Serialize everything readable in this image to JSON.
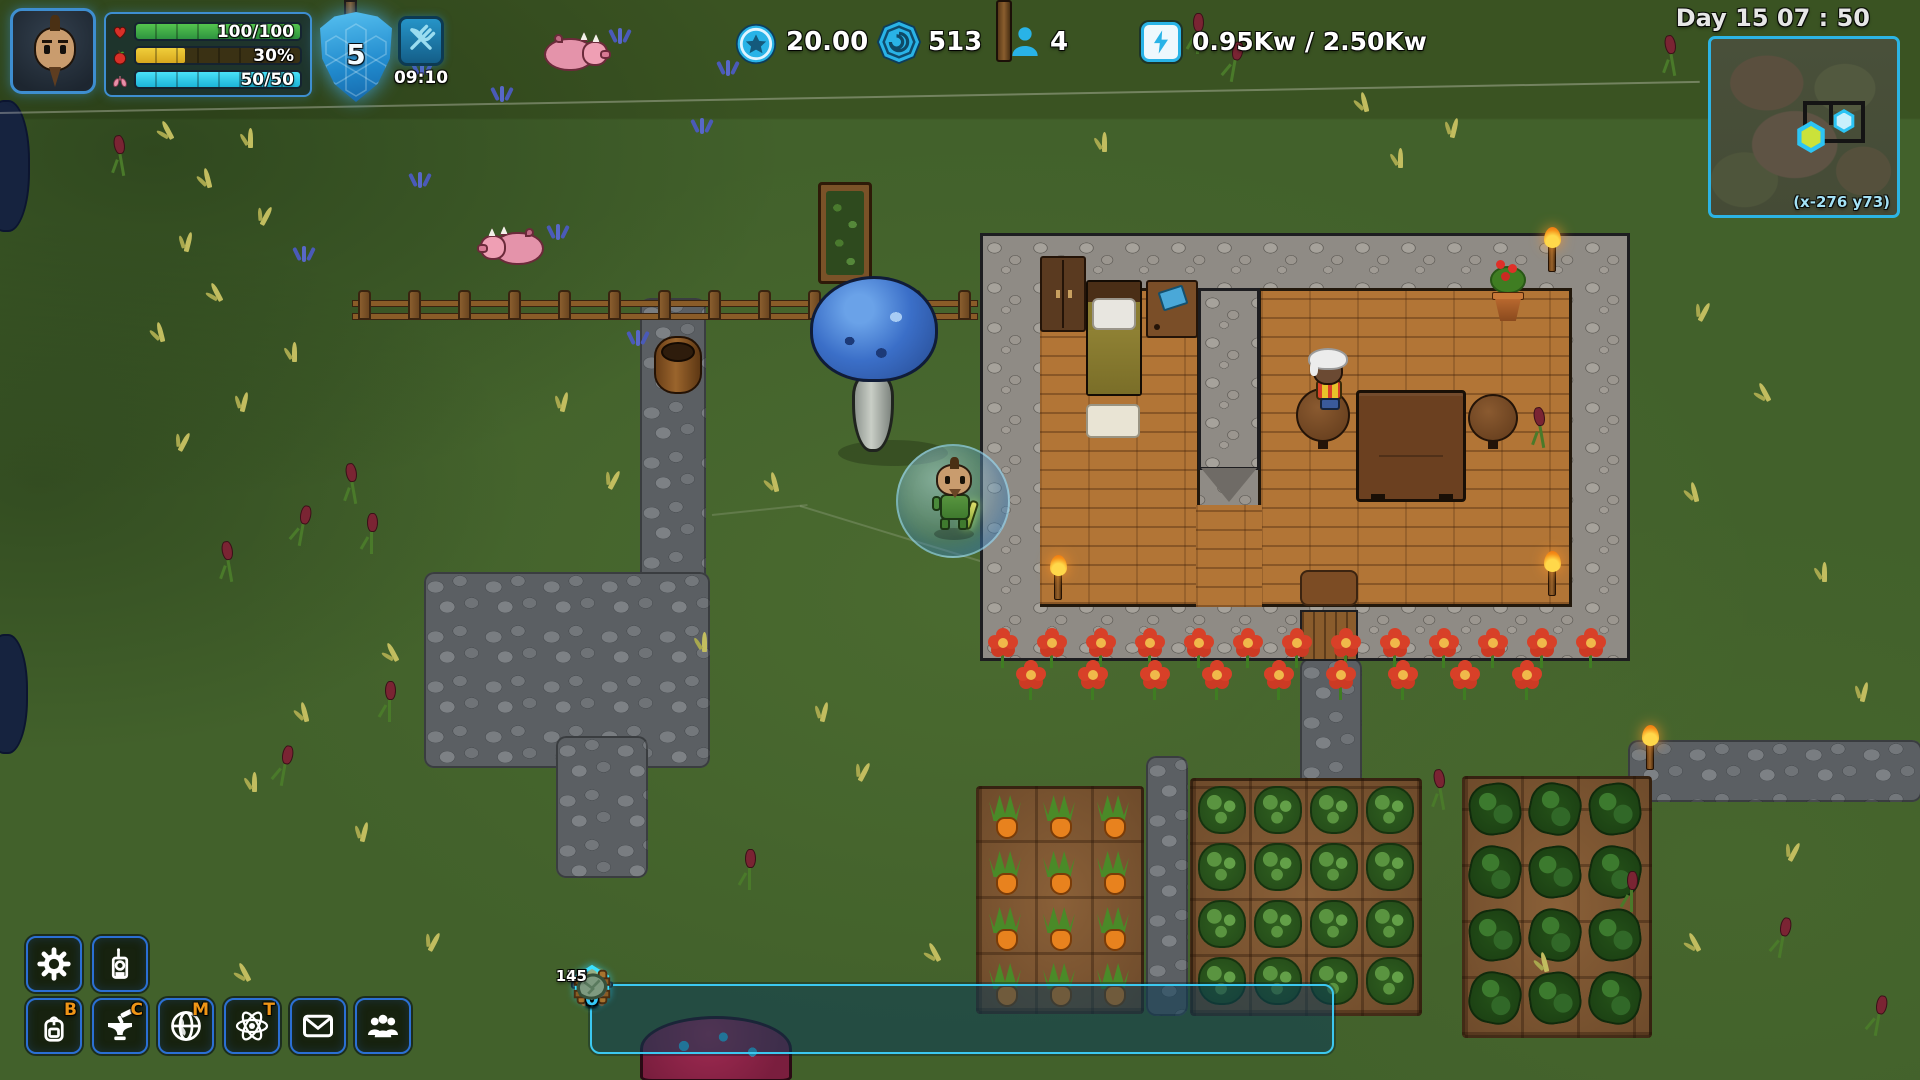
{
  "hud": {
    "player": {
      "health": {
        "value": "100/100",
        "color": "#3fae49",
        "icon": "heart-icon"
      },
      "hunger": {
        "value": "30%",
        "color": "#e8c22f",
        "icon": "apple-icon"
      },
      "oxygen": {
        "value": "50/50",
        "color": "#35d5ee",
        "icon": "lungs-icon"
      }
    },
    "buffs": {
      "shield": {
        "value": "5",
        "icon": "shield-hex-icon"
      },
      "food": {
        "timer": "09:10",
        "icon": "fork-knife-icon"
      }
    },
    "resources": {
      "coins": {
        "value": "20.00",
        "icon": "star-coin-icon"
      },
      "gems": {
        "value": "513",
        "icon": "hex-gem-icon"
      },
      "settlers": {
        "value": "4",
        "icon": "person-icon"
      },
      "power": {
        "value": "0.95Kw / 2.50Kw",
        "icon": "lightning-icon"
      }
    },
    "clock": {
      "label": "Day 15 07 : 50"
    },
    "minimap": {
      "coordinates": "(x-276 y73)"
    },
    "menu": {
      "settings": {
        "hotkey": "",
        "icon": "gear-icon"
      },
      "radio": {
        "hotkey": "",
        "icon": "radio-icon"
      },
      "inventory": {
        "hotkey": "B",
        "icon": "backpack-icon"
      },
      "crafting": {
        "hotkey": "C",
        "icon": "anvil-icon"
      },
      "map": {
        "hotkey": "M",
        "icon": "globe-icon"
      },
      "tech": {
        "hotkey": "T",
        "icon": "atom-icon"
      },
      "mail": {
        "hotkey": "",
        "icon": "envelope-icon"
      },
      "settlers_menu": {
        "hotkey": "",
        "icon": "people-icon"
      }
    },
    "hotbar": {
      "selected_slot": "3",
      "slots": [
        {
          "key": "1",
          "item": "pickaxe",
          "count": ""
        },
        {
          "key": "2",
          "item": "axe",
          "count": ""
        },
        {
          "key": "3",
          "item": "glowstick",
          "count": ""
        },
        {
          "key": "4",
          "item": "submachine-gun",
          "count": ""
        },
        {
          "key": "5",
          "item": "torch",
          "count": ""
        },
        {
          "key": "6",
          "item": "sonar-device",
          "count": "2"
        },
        {
          "key": "7",
          "item": "wood-fence",
          "count": "117"
        },
        {
          "key": "8",
          "item": "stone",
          "count": "3"
        },
        {
          "key": "9",
          "item": "gold-chunk",
          "count": "3"
        },
        {
          "key": "0",
          "item": "ore-chunk",
          "count": "45"
        }
      ]
    },
    "colors": {
      "accent": "#2fb9e8",
      "hotkey": "#ef9516"
    }
  }
}
